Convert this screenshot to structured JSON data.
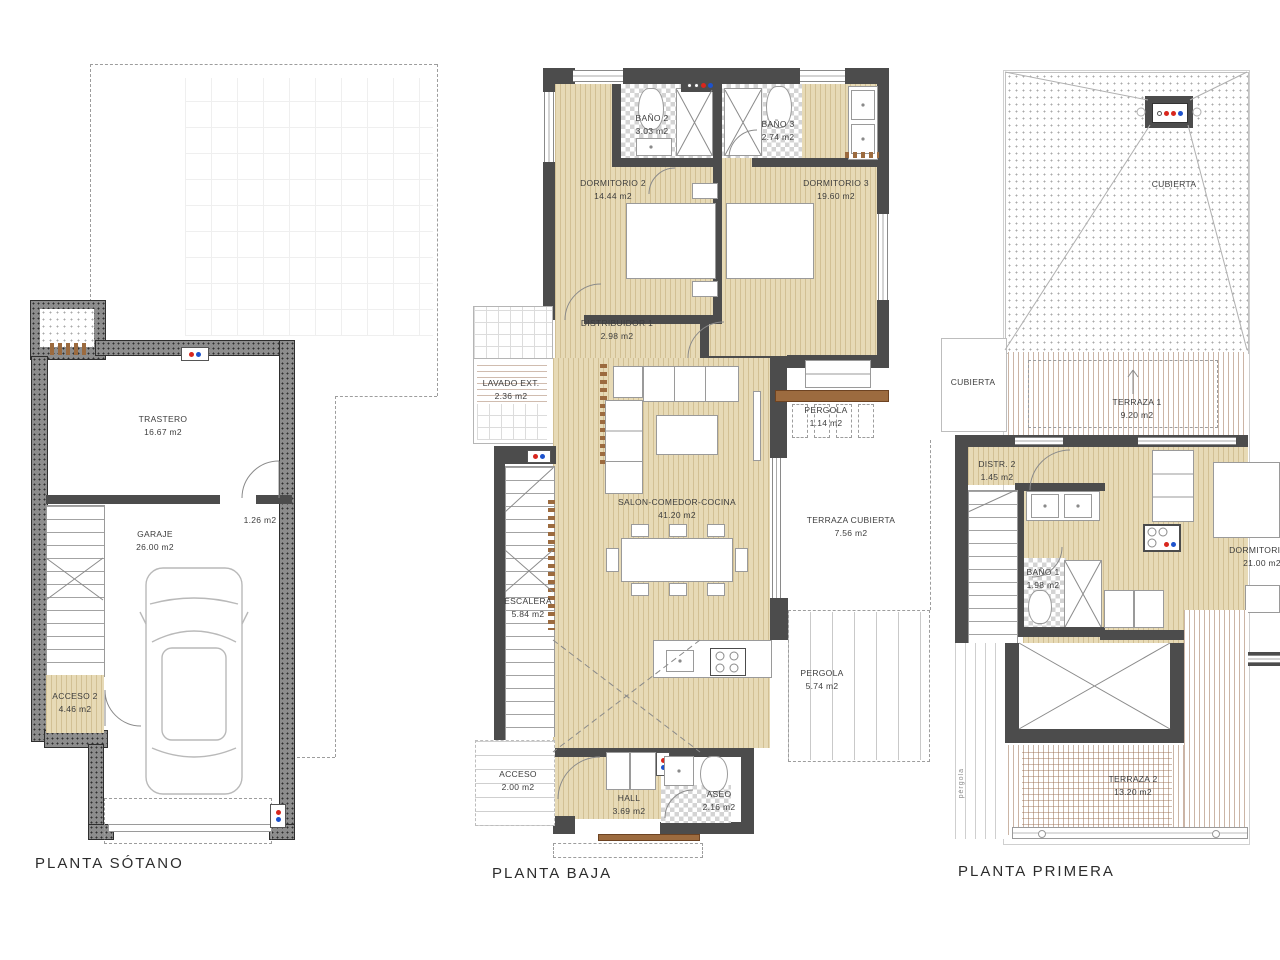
{
  "titles": {
    "sotano": "PLANTA SÓTANO",
    "baja": "PLANTA BAJA",
    "primera": "PLANTA PRIMERA"
  },
  "sotano": {
    "trastero": {
      "name": "TRASTERO",
      "area": "16.67 m2"
    },
    "garaje": {
      "name": "GARAJE",
      "area": "26.00 m2"
    },
    "acceso2": {
      "name": "ACCESO 2",
      "area": "4.46 m2"
    },
    "puerta": {
      "area": "1.26 m2"
    }
  },
  "baja": {
    "bano2": {
      "name": "BAÑO 2",
      "area": "3.03 m2"
    },
    "bano3": {
      "name": "BAÑO 3",
      "area": "2.74 m2"
    },
    "dormitorio2": {
      "name": "DORMITORIO 2",
      "area": "14.44 m2"
    },
    "dormitorio3": {
      "name": "DORMITORIO 3",
      "area": "19.60 m2"
    },
    "distribuidor1": {
      "name": "DISTRIBUIDOR 1",
      "area": "2.98 m2"
    },
    "lavado": {
      "name": "LAVADO EXT.",
      "area": "2.36 m2"
    },
    "pergola1": {
      "name": "PERGOLA",
      "area": "1.14 m2"
    },
    "salon": {
      "name": "SALON-COMEDOR-COCINA",
      "area": "41.20 m2"
    },
    "terraza_cubierta": {
      "name": "TERRAZA CUBIERTA",
      "area": "7.56 m2"
    },
    "escalera": {
      "name": "ESCALERA",
      "area": "5.84 m2"
    },
    "pergola2": {
      "name": "PERGOLA",
      "area": "5.74 m2"
    },
    "acceso": {
      "name": "ACCESO",
      "area": "2.00 m2"
    },
    "hall": {
      "name": "HALL",
      "area": "3.69 m2"
    },
    "aseo": {
      "name": "ASEO",
      "area": "2.16 m2"
    }
  },
  "primera": {
    "cubierta": {
      "name": "CUBIERTA"
    },
    "cubierta2": {
      "name": "CUBIERTA"
    },
    "terraza1": {
      "name": "TERRAZA 1",
      "area": "9.20 m2"
    },
    "distr2": {
      "name": "DISTR. 2",
      "area": "1.45 m2"
    },
    "bano1": {
      "name": "BAÑO 1",
      "area": "1.98 m2"
    },
    "dormitorio1": {
      "name": "DORMITORIO 1",
      "area": "21.00 m2"
    },
    "terraza2": {
      "name": "TERRAZA 2",
      "area": "13.20 m2"
    },
    "pergola_side": {
      "name": "pérgola"
    }
  },
  "colors": {
    "floor_wood": "#e7dab6",
    "wall_dark": "#4c4c4c",
    "wall_speckled": "#8d8d8d",
    "sill_brown": "#9c6b3f",
    "hot_water_red": "#d8261d",
    "cold_water_blue": "#1d52cc"
  }
}
